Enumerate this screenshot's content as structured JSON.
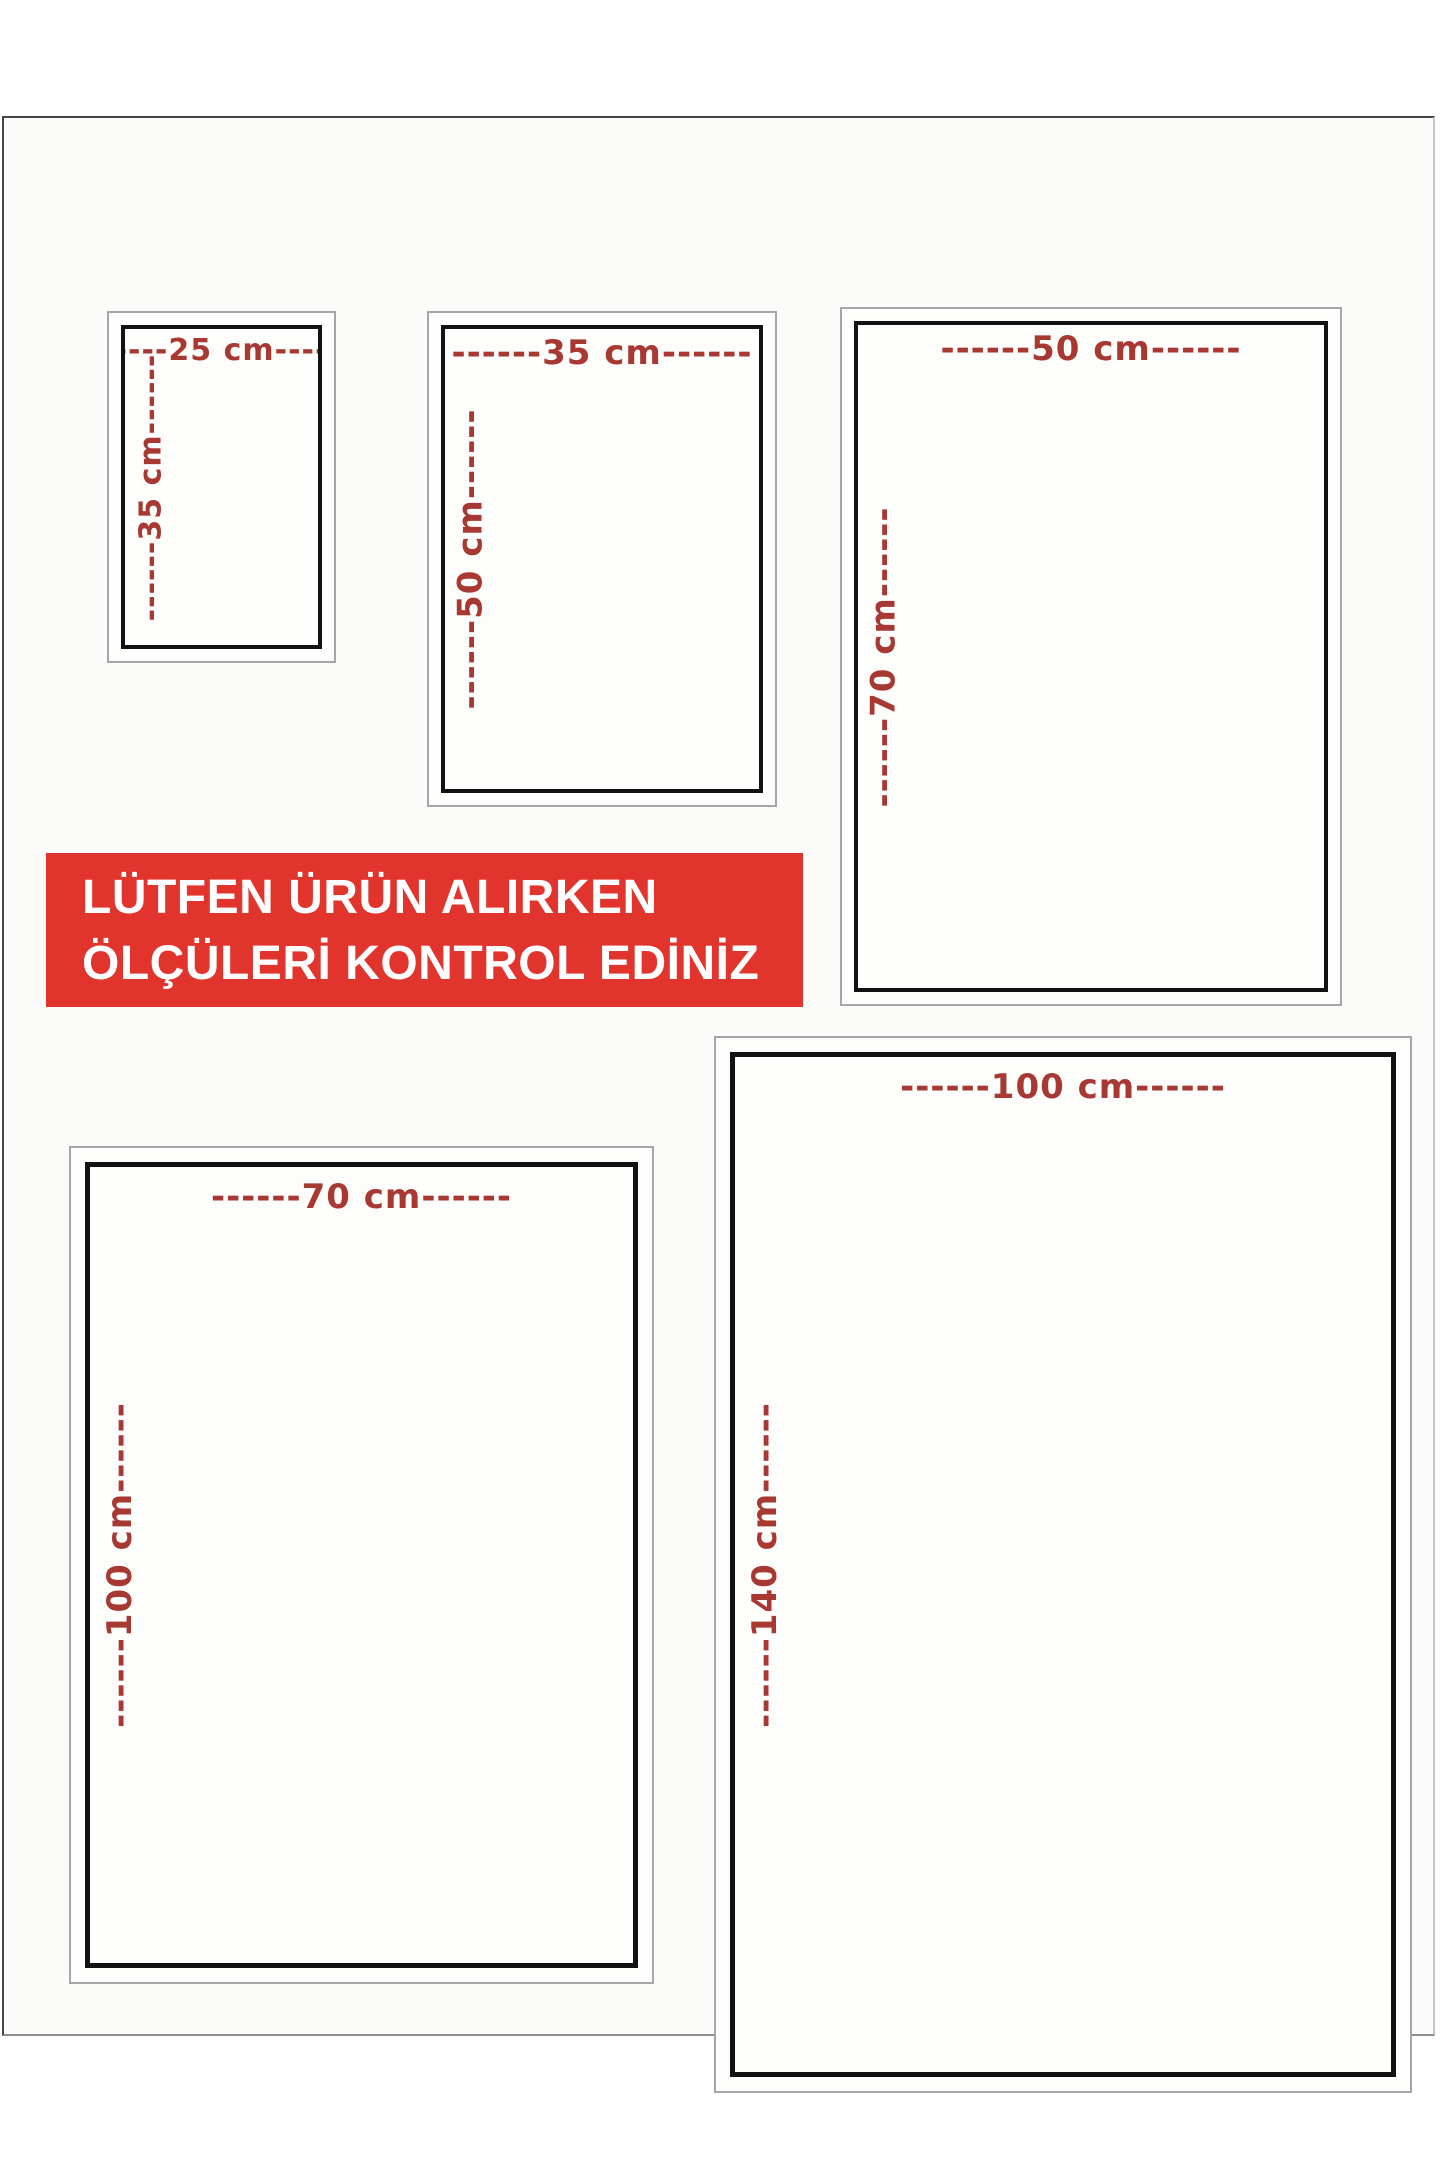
{
  "banner": {
    "line1": "LÜTFEN ÜRÜN ALIRKEN",
    "line2": "ÖLÇÜLERİ KONTROL EDİNİZ"
  },
  "colors": {
    "banner_bg": "#e0342c",
    "banner_text": "#ffffff",
    "dimension_label": "#a83832",
    "box_border": "#121212",
    "box_outline": "#a6a6a6",
    "page_bg": "#fbfbf9"
  },
  "sizes": [
    {
      "id": "25x35",
      "width_cm": 25,
      "height_cm": 35,
      "width_label": "------25 cm------",
      "height_label": "------35 cm------"
    },
    {
      "id": "35x50",
      "width_cm": 35,
      "height_cm": 50,
      "width_label": "------35 cm------",
      "height_label": "------50 cm------"
    },
    {
      "id": "50x70",
      "width_cm": 50,
      "height_cm": 70,
      "width_label": "------50 cm------",
      "height_label": "------70 cm------"
    },
    {
      "id": "70x100",
      "width_cm": 70,
      "height_cm": 100,
      "width_label": "------70 cm------",
      "height_label": "------100 cm------"
    },
    {
      "id": "100x140",
      "width_cm": 100,
      "height_cm": 140,
      "width_label": "------100 cm------",
      "height_label": "------140 cm------"
    }
  ]
}
